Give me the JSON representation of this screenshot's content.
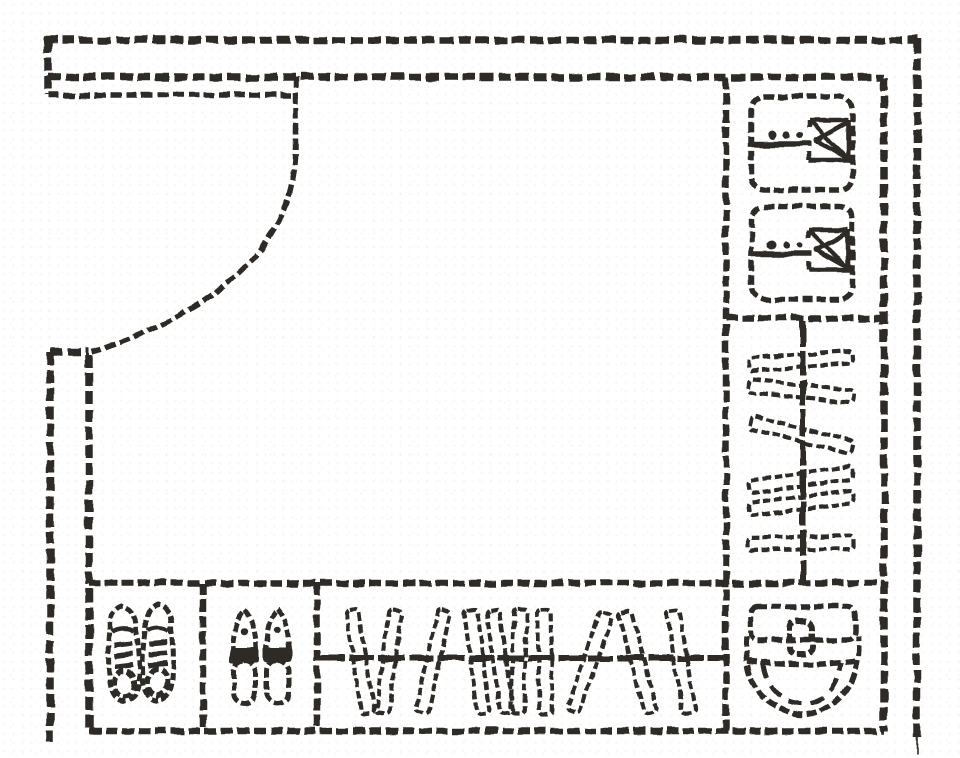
{
  "meta": {
    "type": "floor-plan-sketch",
    "subject": "entry walk-in shoe closet layout, hand-drawn top view",
    "canvas": {
      "width": 960,
      "height": 758
    }
  },
  "palette": {
    "background": "#ffffff",
    "ink": "#2e2b28"
  },
  "room": {
    "door": {
      "name": "entry-door",
      "style": "single-leaf with quarter-circle swing arc",
      "hinge_corner": "top-left"
    },
    "walls": {
      "top": "double-line",
      "right": "double-line",
      "left": "double-line below door opening",
      "bottom": "cabinet edge only"
    }
  },
  "right_column": {
    "sections": [
      {
        "name": "folded-garment-shelf",
        "item": "folded-garment",
        "count": 2
      },
      {
        "name": "vertical-hanging-rod-section",
        "item": "hanging-garment",
        "count": 6
      },
      {
        "name": "bag-cubby",
        "item": "handbag",
        "count": 1
      }
    ]
  },
  "bottom_row": {
    "sections": [
      {
        "name": "sneaker-cubby",
        "item": "sneaker",
        "count": 2
      },
      {
        "name": "slipper-cubby",
        "item": "slipper",
        "count": 2
      },
      {
        "name": "horizontal-hanging-rod-section",
        "item": "hanging-garment",
        "count": 10
      }
    ]
  },
  "generated": {
    "right_hang_bars": [
      {
        "y": 361,
        "angle": -4
      },
      {
        "y": 391,
        "angle": 6
      },
      {
        "y": 435,
        "angle": 14
      },
      {
        "y": 480,
        "angle": -8
      },
      {
        "y": 503,
        "angle": -7
      },
      {
        "y": 543,
        "angle": -1
      }
    ],
    "bottom_hang_bars": [
      {
        "x": 360,
        "angle": -9
      },
      {
        "x": 389,
        "angle": 7
      },
      {
        "x": 433,
        "angle": 13
      },
      {
        "x": 477,
        "angle": -7
      },
      {
        "x": 500,
        "angle": -8
      },
      {
        "x": 519,
        "angle": 2
      },
      {
        "x": 545,
        "angle": -1
      },
      {
        "x": 590,
        "angle": 19
      },
      {
        "x": 638,
        "angle": -15
      },
      {
        "x": 681,
        "angle": -9
      }
    ],
    "folded_garments": [
      {
        "x": 750,
        "y": 95
      },
      {
        "x": 750,
        "y": 205
      }
    ],
    "sneakers": [
      {
        "x": 104,
        "y": 604,
        "angle": -2
      },
      {
        "x": 141,
        "y": 602,
        "angle": 1
      }
    ],
    "slippers": [
      {
        "x": 230,
        "y": 608,
        "angle": 0
      },
      {
        "x": 263,
        "y": 607,
        "angle": 0
      }
    ]
  }
}
